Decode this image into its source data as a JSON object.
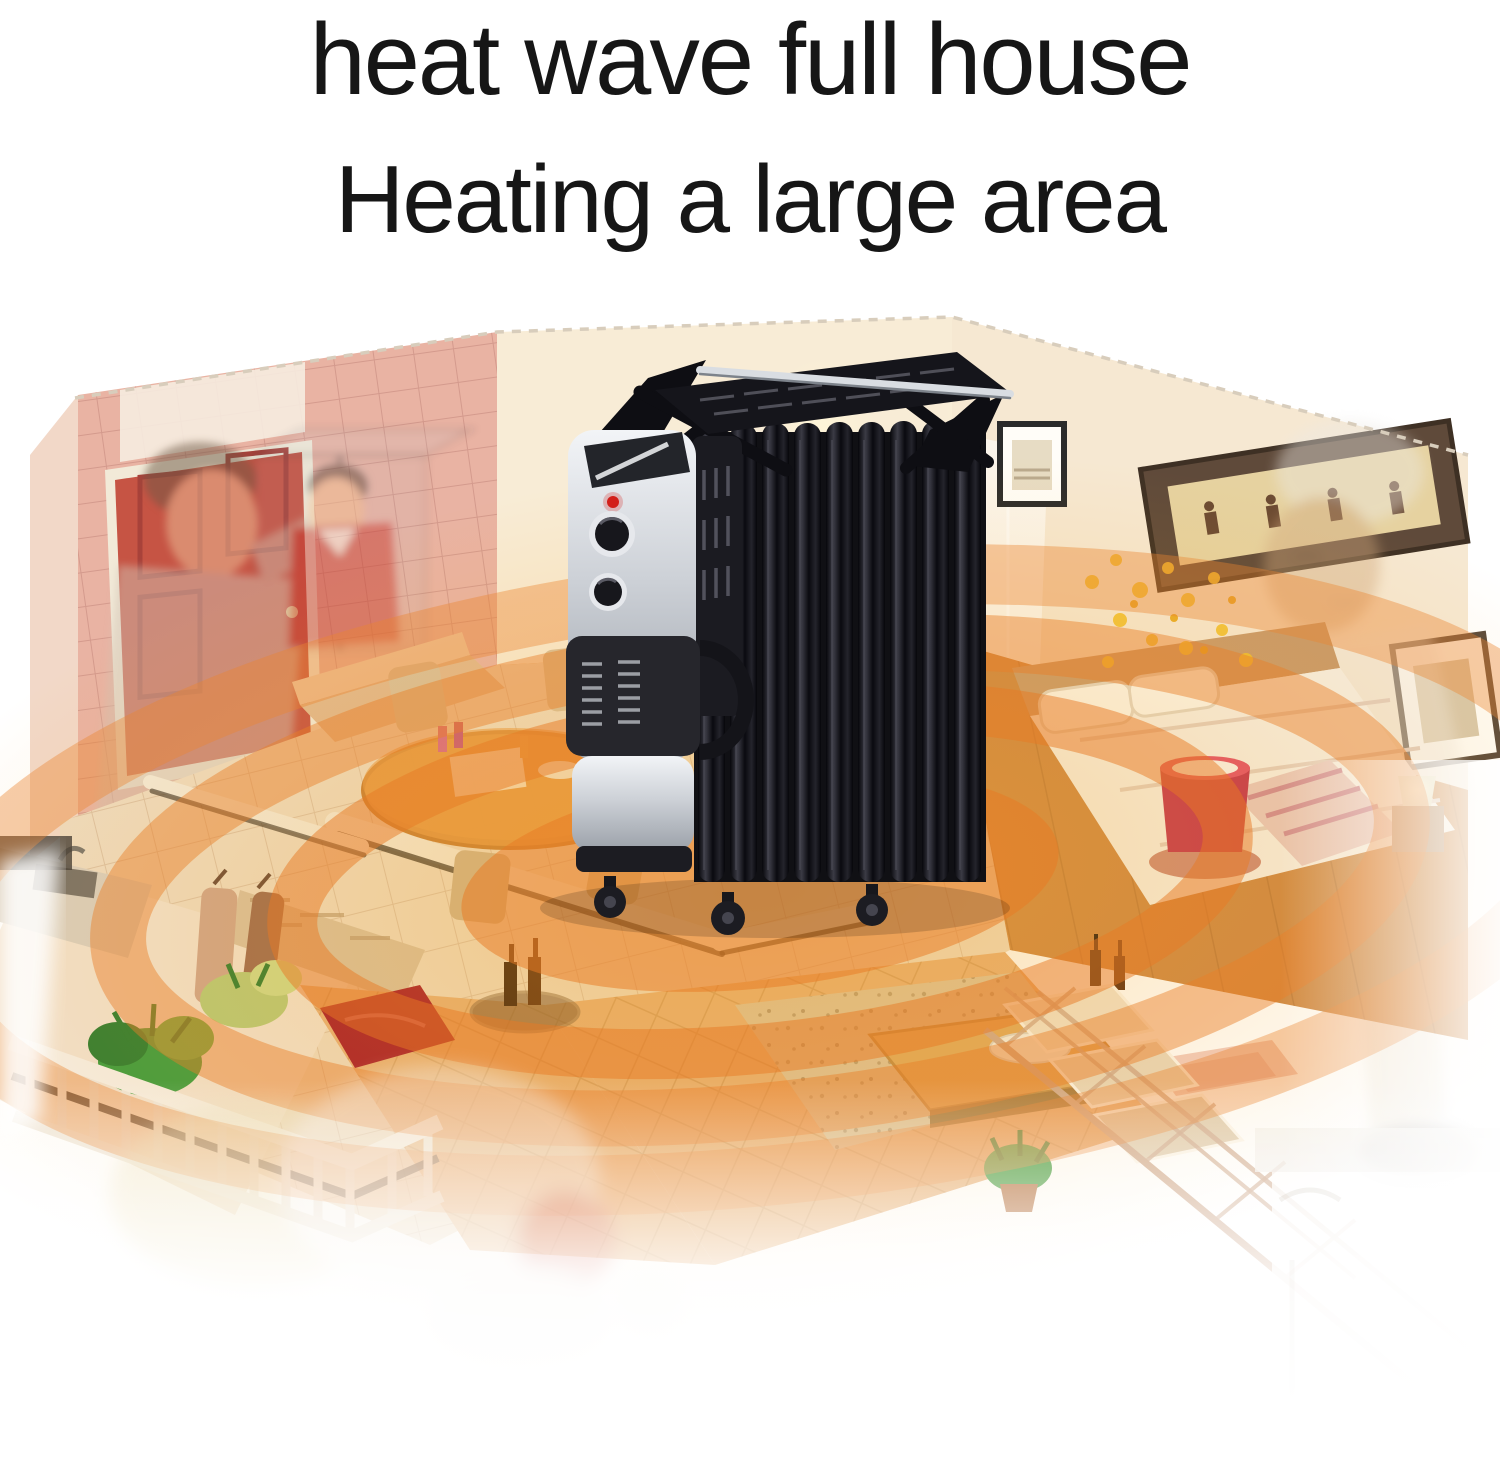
{
  "title": {
    "line1": "heat wave full house",
    "line2": "Heating a large area"
  },
  "product": {
    "type": "oil-filled radiator heater",
    "color_scheme": "black fins with silver control tower",
    "features_visible": [
      "drying-rack",
      "chrome-rack-bar",
      "control-panel",
      "thermostat-knob",
      "power-knob",
      "indicator-light",
      "radiator-fins",
      "vent-grille",
      "carry-handle",
      "caster-wheels"
    ]
  },
  "scene": {
    "type": "isometric-cutaway-house",
    "rooms": [
      "entry-hall",
      "dining-area",
      "living-room-pit",
      "bedroom",
      "kitchen",
      "balcony",
      "staircase"
    ],
    "overlays": [
      "father-and-child-ghost",
      "elderly-man-ghost",
      "baby-ghost"
    ],
    "heat_rings_count": 4,
    "colors": {
      "background": "#ffffff",
      "title_text": "#161616",
      "heat_ring": "#e87a24",
      "heat_glow": "#f5a623",
      "wall_cream": "#f7ead4",
      "wall_pink": "#e9b3a3",
      "door_red": "#c65444",
      "floor_tile": "#eedcc2",
      "floor_wood": "#cd8745",
      "quilt_sofa_tan": "#e7b078",
      "heater_black": "#121217",
      "heater_silver": "#d3d6db",
      "indicator_red": "#d21f1a",
      "lamp_red": "#c23350",
      "plant_green": "#3e9c3f",
      "flower_yellow": "#f2c12e"
    }
  }
}
